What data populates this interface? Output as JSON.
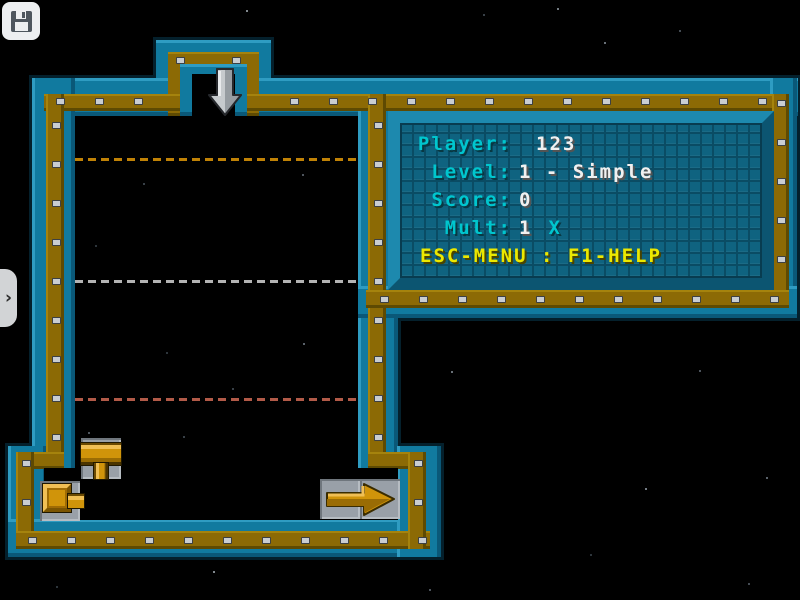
{
  "hud": {
    "rows": [
      {
        "label": "Player:",
        "value": "123"
      },
      {
        "label": "Level:",
        "value": "1 - Simple"
      },
      {
        "label": "Score:",
        "value": "0"
      },
      {
        "label": "Mult:",
        "value": "1",
        "suffix": "X"
      }
    ],
    "help_text": "ESC-MENU : F1-HELP"
  },
  "overlay": {
    "save_button_icon": "floppy-disk-icon",
    "expander_glyph": "›"
  },
  "board": {
    "pieces": {
      "falling_piece": "down-arrow-piece",
      "left_upper_piece": "t-pipe-piece",
      "left_lower_piece": "start-cap-piece",
      "right_piece": "exit-arrow-piece"
    },
    "guide_lines": [
      {
        "y": 158,
        "color": "#c08206"
      },
      {
        "y": 280,
        "color": "#b4b4b4"
      },
      {
        "y": 398,
        "color": "#b25a48"
      }
    ]
  },
  "colors": {
    "wall_teal": "#117a9f",
    "wall_gold": "#8c6a05",
    "panel_background": "#0f6380",
    "hud_cyan": "#00c6ce",
    "hud_white": "#f0f0f0",
    "hud_yellow": "#ece800",
    "pipe_gold": "#d0940a",
    "tile_gray": "#99a0a8"
  }
}
